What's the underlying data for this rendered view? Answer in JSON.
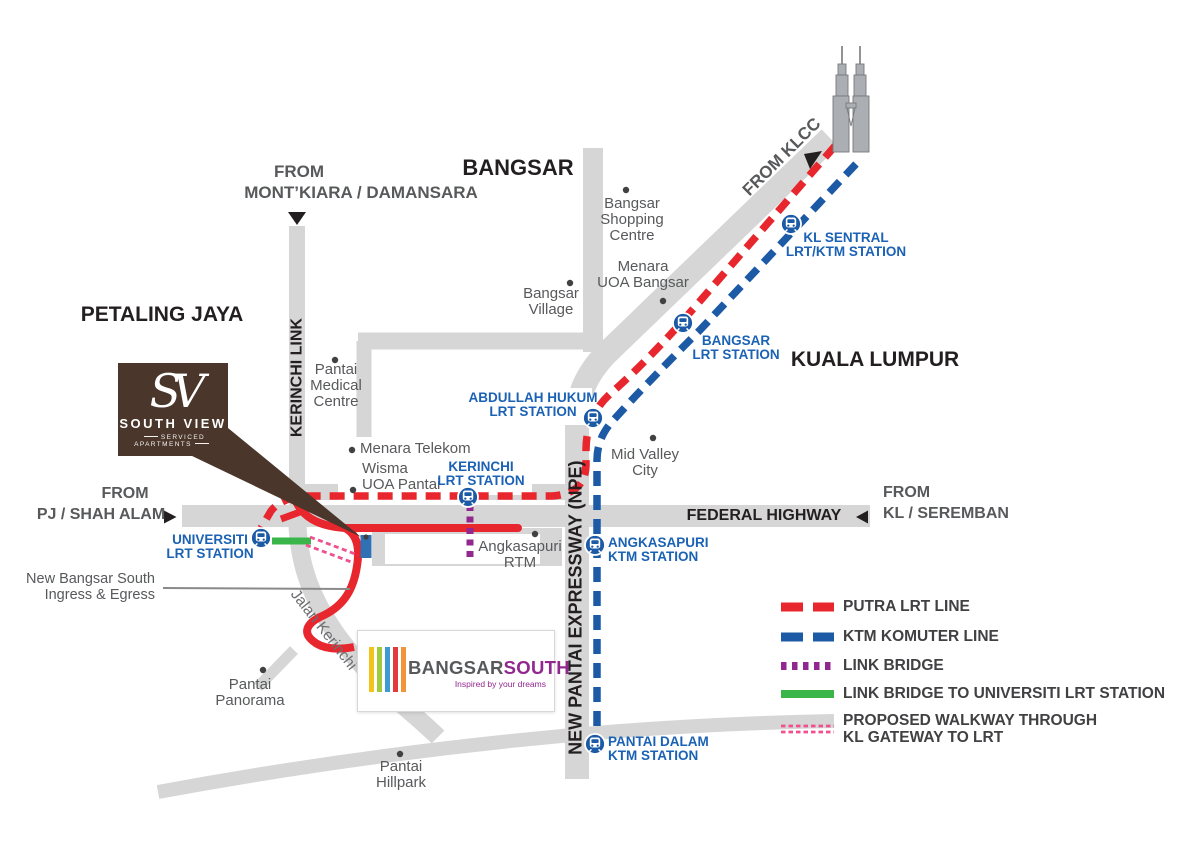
{
  "map_title_labels": {
    "bangsar": "BANGSAR",
    "petaling_jaya": "PETALING JAYA",
    "kuala_lumpur": "KUALA LUMPUR"
  },
  "directions": {
    "from_montkiara_line1": "FROM",
    "from_montkiara_line2": "MONT’KIARA / DAMANSARA",
    "from_klcc": "FROM KLCC",
    "from_pj_line1": "FROM",
    "from_pj_line2": "PJ / SHAH ALAM",
    "from_kl_line1": "FROM",
    "from_kl_line2": "KL / SEREMBAN"
  },
  "roads": {
    "federal_highway": "FEDERAL HIGHWAY",
    "new_pantai_expressway": "NEW PANTAI EXPRESSWAY (NPE)",
    "kerinchi_link": "KERINCHI LINK",
    "jalan_kerinchi": "Jalan Kerinchi"
  },
  "stations": [
    {
      "id": "kl-sentral",
      "line1": "KL SENTRAL",
      "line2": "LRT/KTM STATION"
    },
    {
      "id": "bangsar",
      "line1": "BANGSAR",
      "line2": "LRT STATION"
    },
    {
      "id": "abdullah-hukum",
      "line1": "ABDULLAH HUKUM",
      "line2": "LRT STATION"
    },
    {
      "id": "kerinchi",
      "line1": "KERINCHI",
      "line2": "LRT STATION"
    },
    {
      "id": "universiti",
      "line1": "UNIVERSITI",
      "line2": "LRT STATION"
    },
    {
      "id": "angkasapuri",
      "line1": "ANGKASAPURI",
      "line2": "KTM STATION"
    },
    {
      "id": "pantai-dalam",
      "line1": "PANTAI DALAM",
      "line2": "KTM STATION"
    }
  ],
  "places": [
    {
      "lines": [
        "Bangsar",
        "Shopping",
        "Centre"
      ]
    },
    {
      "lines": [
        "Menara",
        "UOA Bangsar"
      ]
    },
    {
      "lines": [
        "Bangsar",
        "Village"
      ]
    },
    {
      "lines": [
        "Pantai",
        "Medical",
        "Centre"
      ]
    },
    {
      "lines": [
        "Menara Telekom"
      ]
    },
    {
      "lines": [
        "Wisma",
        "UOA Pantai"
      ]
    },
    {
      "lines": [
        "Mid Valley",
        "City"
      ]
    },
    {
      "lines": [
        "Angkasapuri",
        "RTM"
      ]
    },
    {
      "lines": [
        "Pantai",
        "Panorama"
      ]
    },
    {
      "lines": [
        "Pantai",
        "Hillpark"
      ]
    }
  ],
  "annotations": {
    "ingress_line1": "New Bangsar South",
    "ingress_line2": "Ingress & Egress"
  },
  "legend": {
    "items": [
      {
        "type": "putra-lrt",
        "label": "PUTRA LRT LINE"
      },
      {
        "type": "ktm-komuter",
        "label": "KTM KOMUTER LINE"
      },
      {
        "type": "link-bridge",
        "label": "LINK BRIDGE"
      },
      {
        "type": "link-bridge-universiti",
        "label": "LINK BRIDGE TO UNIVERSITI LRT STATION"
      },
      {
        "type": "proposed-walkway",
        "label": "PROPOSED WALKWAY THROUGH",
        "label2": "KL GATEWAY TO LRT"
      }
    ]
  },
  "logos": {
    "south_view": {
      "monogram": "SV",
      "name": "SOUTH VIEW",
      "tagline": "SERVICED APARTMENTS"
    },
    "bangsar_south": {
      "name_part1": "BANGSAR",
      "name_part2": "SOUTH",
      "tagline": "Inspired by your dreams"
    }
  },
  "colors": {
    "road_gray": "#d6d6d6",
    "putra_red": "#e8262d",
    "ktm_blue": "#1c5aa6",
    "bridge_purple": "#92278f",
    "bridge_green": "#3ab54a",
    "walkway_pink": "#f0508f",
    "station_blue": "#1b62b5",
    "text_dark": "#231f20",
    "text_gray": "#58595b",
    "legend_text": "#414042",
    "south_view_brown": "#4a362a",
    "bs_purple": "#92278f",
    "bar_yellow": "#f3c317",
    "bar_green": "#9fca3b",
    "bar_blue": "#3e9ad4",
    "bar_red": "#e23a3d",
    "bar_orange": "#f2953a",
    "site_marker_blue": "#3070b3"
  }
}
